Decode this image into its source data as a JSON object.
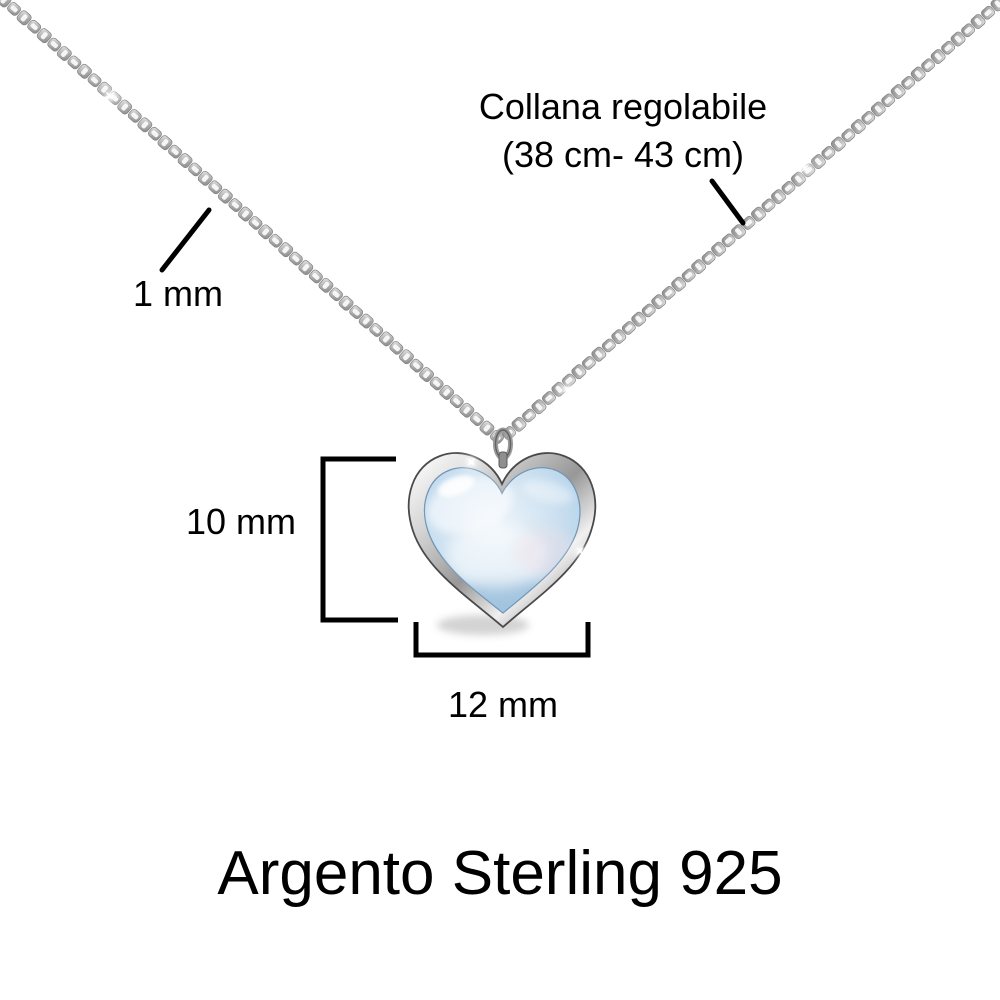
{
  "labels": {
    "adjustable_length_line1": "Collana regolabile",
    "adjustable_length_line2": "(38 cm- 43 cm)",
    "chain_thickness": "1 mm",
    "pendant_height": "10 mm",
    "pendant_width": "12 mm",
    "material": "Argento Sterling 925"
  },
  "colors": {
    "background": "#ffffff",
    "text": "#000000",
    "marks": "#000000",
    "chain_silver": "#a9a9a9",
    "pendant_silver": "#c9c9c9",
    "stone_blue": "#b7d4ea"
  }
}
